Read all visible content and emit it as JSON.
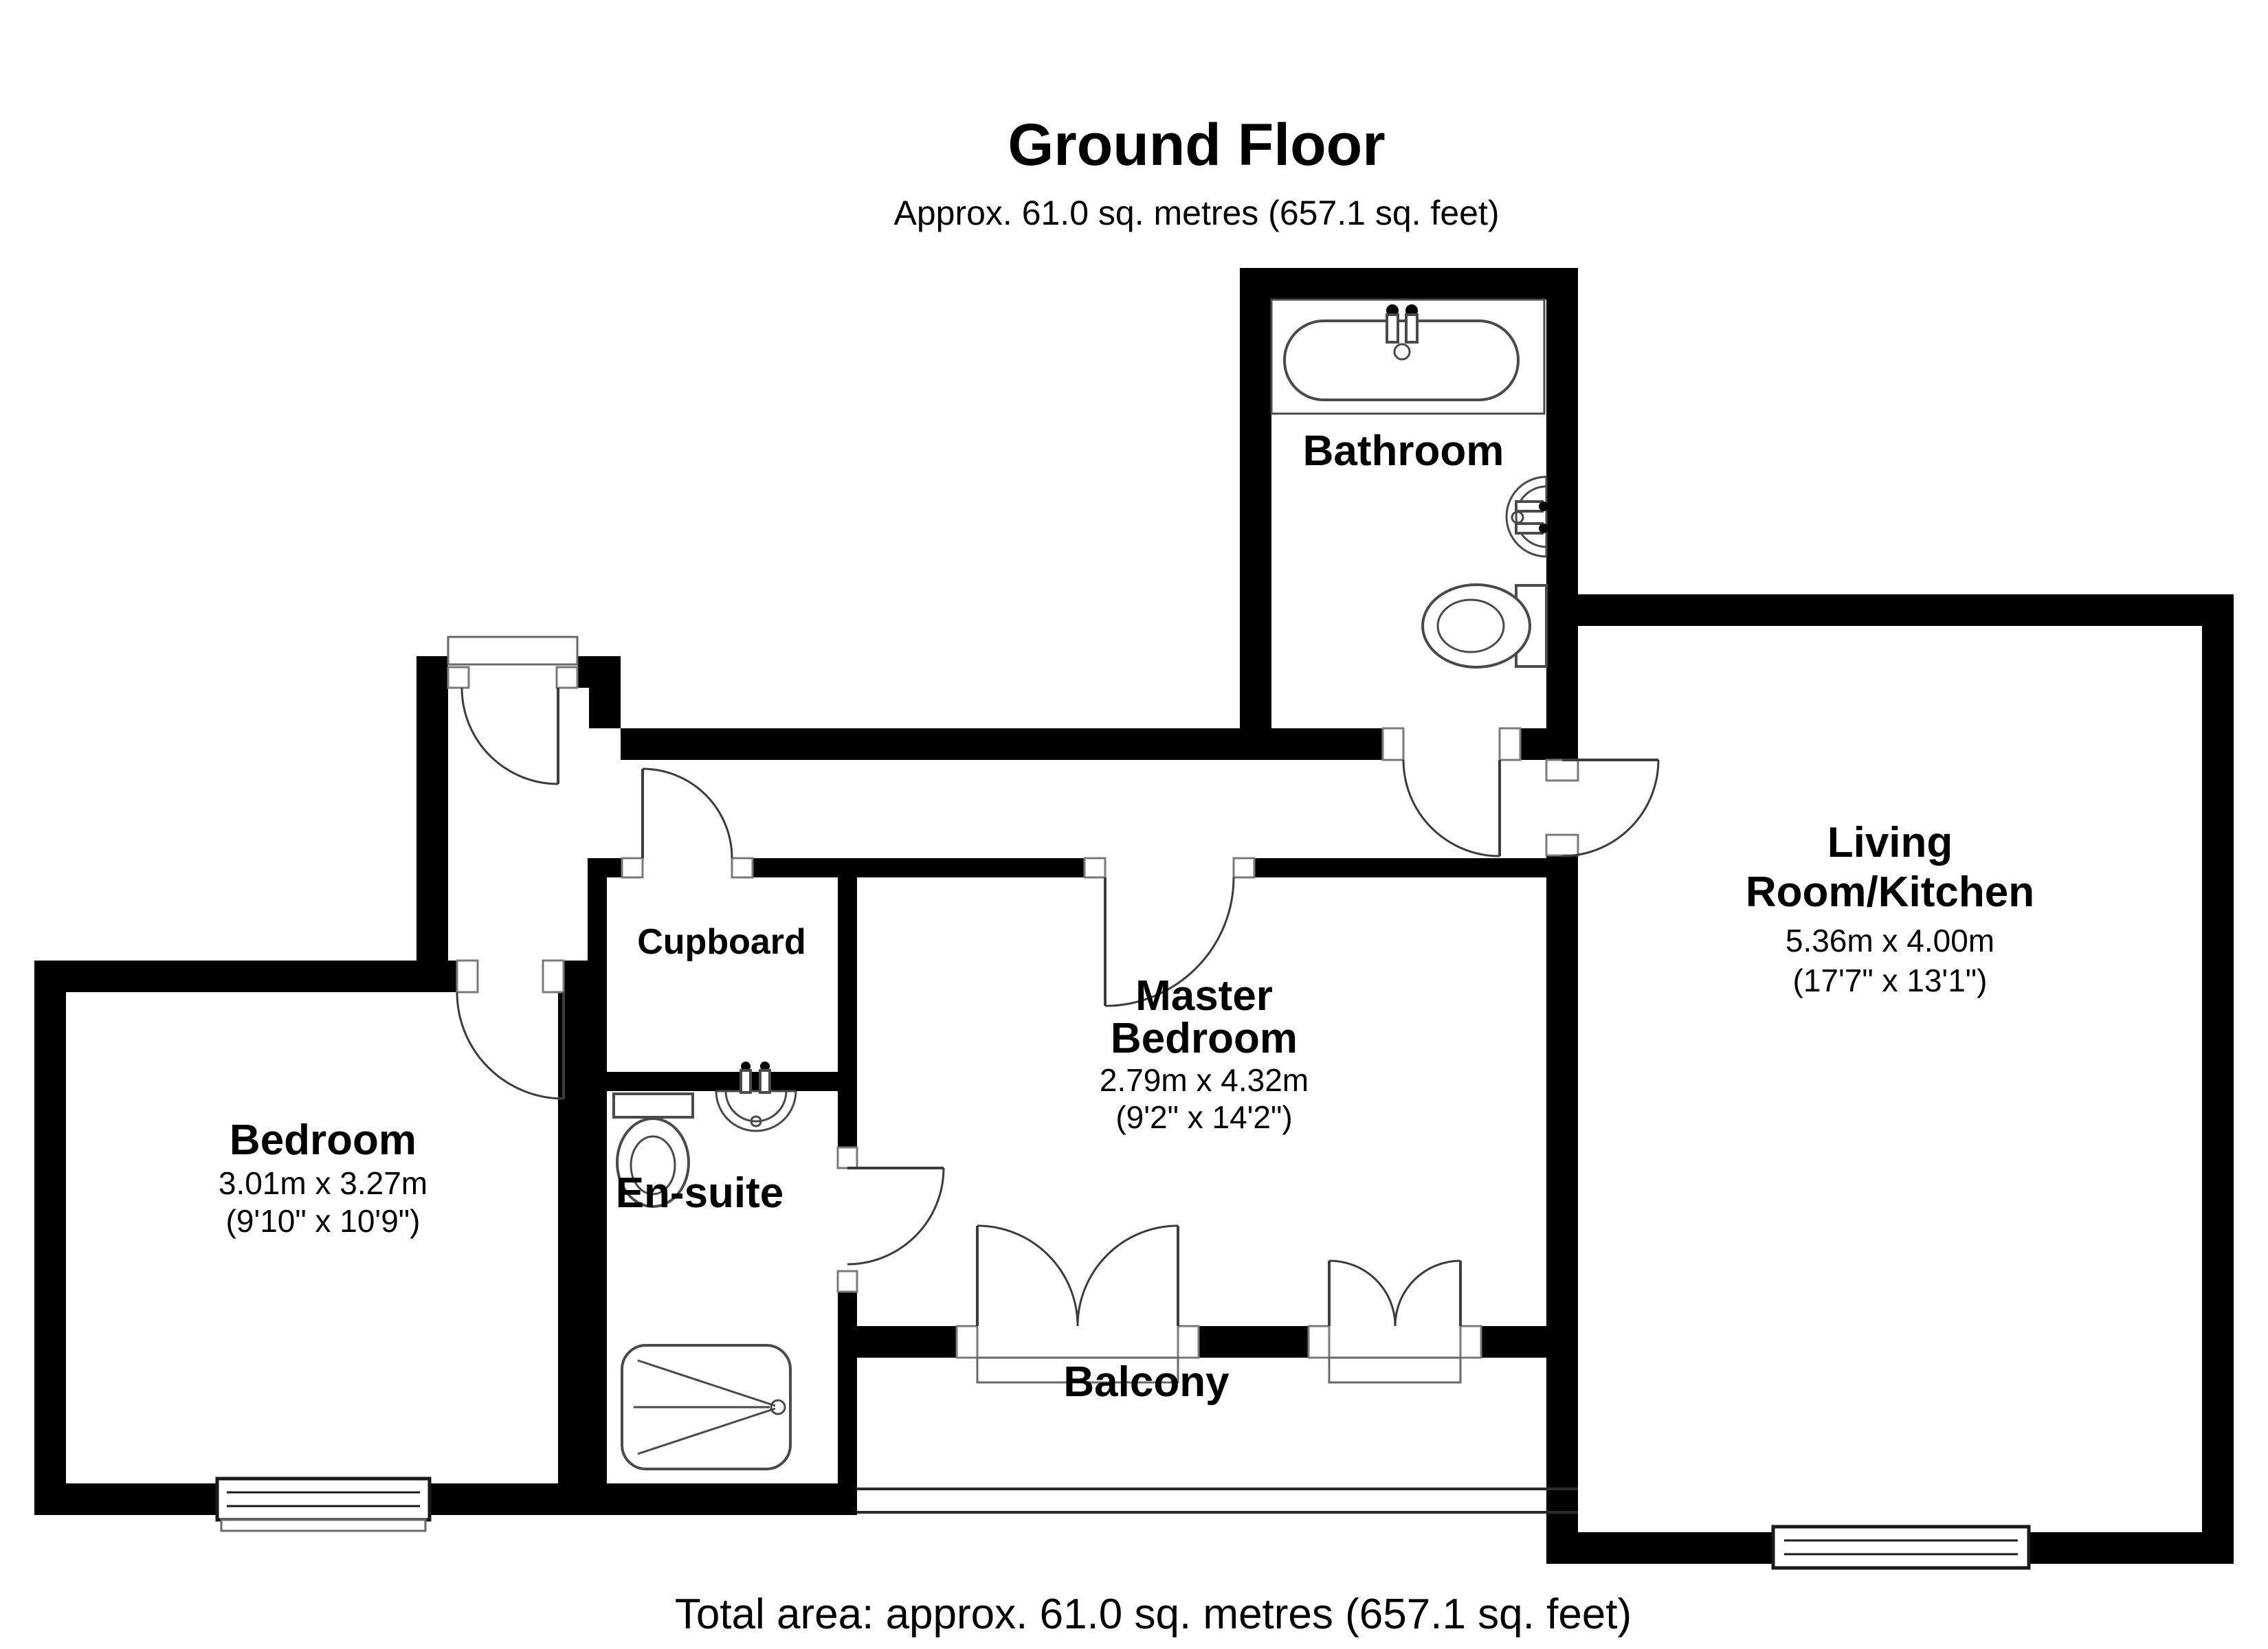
{
  "title": {
    "heading": "Ground Floor",
    "subtitle": "Approx. 61.0 sq. metres (657.1 sq. feet)"
  },
  "footer": {
    "total_area": "Total area: approx. 61.0 sq. metres (657.1 sq. feet)"
  },
  "rooms": {
    "bathroom": {
      "label": "Bathroom"
    },
    "living": {
      "label_line1": "Living",
      "label_line2": "Room/Kitchen",
      "dims_metric": "5.36m x 4.00m",
      "dims_imperial": "(17'7\" x 13'1\")"
    },
    "master": {
      "label_line1": "Master",
      "label_line2": "Bedroom",
      "dims_metric": "2.79m x 4.32m",
      "dims_imperial": "(9'2\" x 14'2\")"
    },
    "bedroom": {
      "label": "Bedroom",
      "dims_metric": "3.01m x 3.27m",
      "dims_imperial": "(9'10\" x 10'9\")"
    },
    "cupboard": {
      "label": "Cupboard"
    },
    "ensuite": {
      "label": "En-suite"
    },
    "balcony": {
      "label": "Balcony"
    }
  },
  "fixtures": {
    "bathtub": "bathtub-icon",
    "bathroom_sink": "sink-icon",
    "bathroom_toilet": "toilet-icon",
    "ensuite_toilet": "toilet-icon",
    "ensuite_sink": "sink-icon",
    "shower": "shower-tray-icon"
  },
  "colors": {
    "wall": "#000000",
    "background": "#ffffff",
    "fixture_line": "#4a4a4a"
  }
}
